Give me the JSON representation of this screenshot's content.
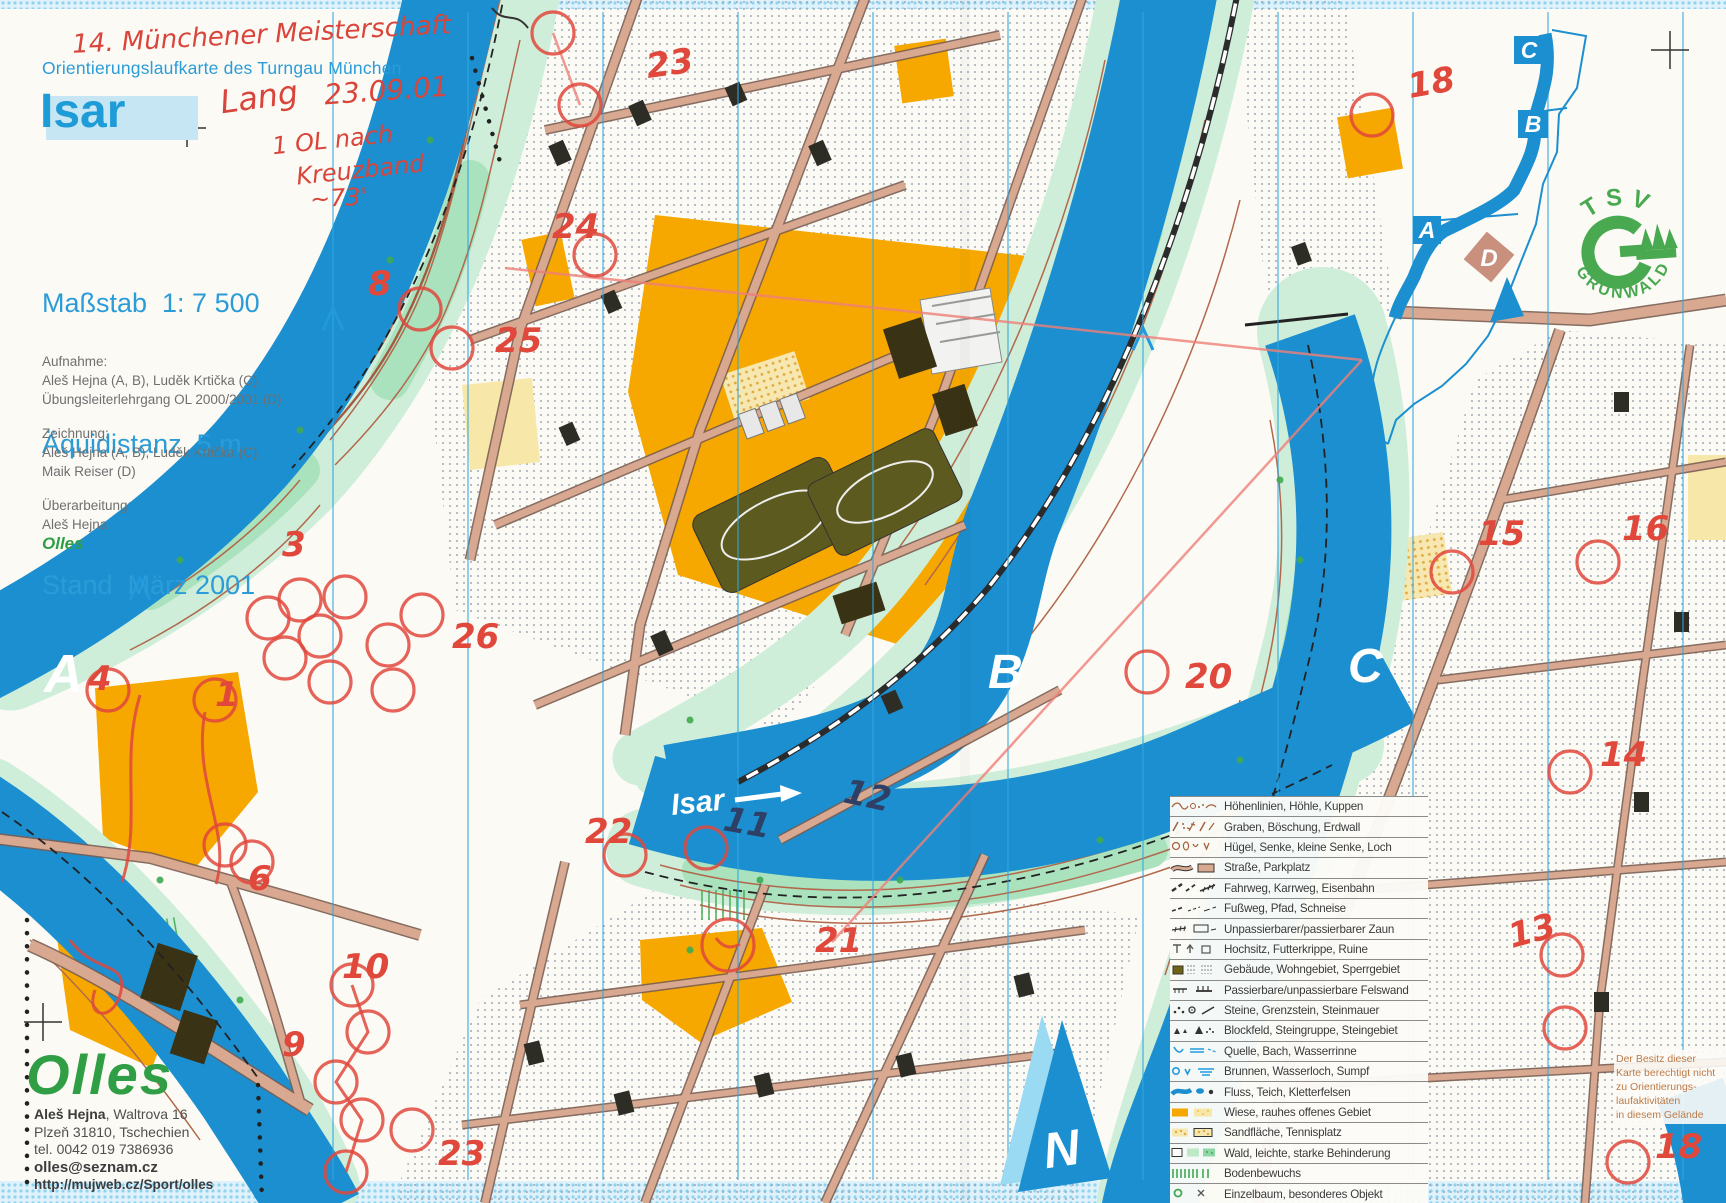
{
  "header": {
    "handwritten_title": "14. Münchener Meisterschaft",
    "subtitle": "Orientierungslaufkarte des Turngau München",
    "title": "Isar",
    "handwritten_course": "Lang",
    "handwritten_date": "23.09.01",
    "handwritten_note1": "1 OL nach",
    "handwritten_note2": "Kreuzband",
    "handwritten_time": "~73'",
    "scale_label": "Maßstab  1: 7 500",
    "equidistance_label": "Äquidistanz  5 m",
    "stand_label": "Stand  März 2001"
  },
  "credits": {
    "survey_heading": "Aufnahme:",
    "survey_line1": "Aleš Hejna (A, B), Luděk Krtička (C),",
    "survey_line2": "Übungsleiterlehrgang OL 2000/2001 (D)",
    "drawing_heading": "Zeichnung:",
    "drawing_line1": "Aleš Hejna (A, B), Luděk Krtička (C),",
    "drawing_line2": "Maik Reiser (D)",
    "revision_heading": "Überarbeitung:",
    "revision_line1": "Aleš Hejna",
    "revision_line2": "Olles"
  },
  "publisher": {
    "logo": "Olles",
    "name": "Aleš Hejna",
    "address_rest": ", Waltrova 16",
    "address_line2": "Plzeň 31810, Tschechien",
    "address_line3": "tel. 0042 019 7386936",
    "email": "olles@seznam.cz",
    "website": "http://mujweb.cz/Sport/olles"
  },
  "map": {
    "river_label": "Isar",
    "sections": {
      "a": "A",
      "b": "B",
      "c": "C"
    },
    "overview": {
      "c": "C",
      "b": "B",
      "a": "A",
      "d": "D"
    },
    "club_logo": {
      "top": "TSV",
      "bottom": "GRÜNWALD"
    },
    "north_label": "N",
    "disclaimer_line1": "Der Besitz dieser",
    "disclaimer_line2": "Karte berechtigt nicht",
    "disclaimer_line3": "zu Orientierungs-",
    "disclaimer_line4": "laufaktivitäten",
    "disclaimer_line5": "in diesem Gelände"
  },
  "legend": {
    "items": [
      {
        "icon": "contours",
        "label": "Höhenlinien, Höhle, Kuppen"
      },
      {
        "icon": "graben",
        "label": "Graben, Böschung, Erdwall"
      },
      {
        "icon": "huegel",
        "label": "Hügel, Senke, kleine Senke, Loch"
      },
      {
        "icon": "strasse",
        "label": "Straße, Parkplatz"
      },
      {
        "icon": "fahrweg",
        "label": "Fahrweg, Karrweg, Eisenbahn"
      },
      {
        "icon": "fussweg",
        "label": "Fußweg, Pfad, Schneise"
      },
      {
        "icon": "zaun",
        "label": "Unpassierbarer/passierbarer Zaun"
      },
      {
        "icon": "hochsitz",
        "label": "Hochsitz, Futterkrippe, Ruine"
      },
      {
        "icon": "gebaeude",
        "label": "Gebäude, Wohngebiet, Sperrgebiet"
      },
      {
        "icon": "felswand",
        "label": "Passierbare/unpassierbare Felswand"
      },
      {
        "icon": "steine",
        "label": "Steine, Grenzstein, Steinmauer"
      },
      {
        "icon": "blockfeld",
        "label": "Blockfeld, Steingruppe, Steingebiet"
      },
      {
        "icon": "quelle",
        "label": "Quelle, Bach, Wasserrinne"
      },
      {
        "icon": "brunnen",
        "label": "Brunnen, Wasserloch, Sumpf"
      },
      {
        "icon": "fluss",
        "label": "Fluss, Teich, Kletterfelsen"
      },
      {
        "icon": "wiese",
        "label": "Wiese, rauhes offenes Gebiet"
      },
      {
        "icon": "sand",
        "label": "Sandfläche, Tennisplatz"
      },
      {
        "icon": "wald",
        "label": "Wald, leichte, starke Behinderung"
      },
      {
        "icon": "bodenbewuchs",
        "label": "Bodenbewuchs"
      },
      {
        "icon": "einzelbaum",
        "label": "Einzelbaum, besonderes Objekt"
      }
    ]
  },
  "course": {
    "circles": [
      [
        553,
        33
      ],
      [
        580,
        105
      ],
      [
        420,
        309
      ],
      [
        595,
        255
      ],
      [
        452,
        348
      ],
      [
        300,
        600
      ],
      [
        345,
        597
      ],
      [
        320,
        636
      ],
      [
        388,
        645
      ],
      [
        285,
        658
      ],
      [
        330,
        682
      ],
      [
        393,
        690
      ],
      [
        268,
        618
      ],
      [
        215,
        700
      ],
      [
        108,
        690
      ],
      [
        422,
        615
      ],
      [
        225,
        845
      ],
      [
        252,
        862
      ],
      [
        352,
        985
      ],
      [
        368,
        1032
      ],
      [
        336,
        1082
      ],
      [
        362,
        1120
      ],
      [
        346,
        1172
      ],
      [
        412,
        1130
      ],
      [
        625,
        855
      ],
      [
        706,
        848
      ],
      [
        728,
        945,
        26
      ],
      [
        1147,
        672
      ],
      [
        1372,
        115
      ],
      [
        1452,
        572
      ],
      [
        1598,
        562
      ],
      [
        1570,
        772
      ],
      [
        1562,
        955
      ],
      [
        1565,
        1028
      ],
      [
        1628,
        1162
      ]
    ],
    "labels": [
      {
        "t": "23",
        "x": 648,
        "y": 78,
        "r": -8
      },
      {
        "t": "24",
        "x": 552,
        "y": 238
      },
      {
        "t": "8",
        "x": 368,
        "y": 295
      },
      {
        "t": "25",
        "x": 495,
        "y": 352
      },
      {
        "t": "3",
        "x": 282,
        "y": 556
      },
      {
        "t": "26",
        "x": 452,
        "y": 648
      },
      {
        "t": "1",
        "x": 215,
        "y": 706
      },
      {
        "t": "4",
        "x": 88,
        "y": 690
      },
      {
        "t": "6",
        "x": 248,
        "y": 890
      },
      {
        "t": "10",
        "x": 342,
        "y": 978
      },
      {
        "t": "9",
        "x": 282,
        "y": 1056
      },
      {
        "t": "23",
        "x": 438,
        "y": 1165
      },
      {
        "t": "22",
        "x": 585,
        "y": 843
      },
      {
        "t": "21",
        "x": 815,
        "y": 952
      },
      {
        "t": "20",
        "x": 1185,
        "y": 688
      },
      {
        "t": "18",
        "x": 1410,
        "y": 98,
        "r": -10
      },
      {
        "t": "15",
        "x": 1478,
        "y": 545
      },
      {
        "t": "16",
        "x": 1622,
        "y": 540
      },
      {
        "t": "14",
        "x": 1600,
        "y": 766
      },
      {
        "t": "13",
        "x": 1512,
        "y": 948,
        "r": -15
      },
      {
        "t": "18",
        "x": 1655,
        "y": 1158
      },
      {
        "t": "11",
        "x": 722,
        "y": 830,
        "r": 10,
        "c": "dark"
      },
      {
        "t": "12",
        "x": 842,
        "y": 802,
        "r": 12,
        "c": "dark"
      }
    ],
    "legs": [
      [
        505,
        268,
        1362,
        360
      ],
      [
        832,
        942,
        1362,
        360
      ],
      [
        553,
        33,
        580,
        105
      ]
    ]
  },
  "colors": {
    "course_red": "#e0483c",
    "pen_dark": "#2e4066",
    "river_blue": "#1b8fd0",
    "title_blue": "#1e9cd8",
    "print_blue": "#2b9cd8",
    "handwriting_red": "#d9453a",
    "olles_green": "#2f9e44",
    "tsv_green": "#3aa344",
    "open_orange": "#f6a800",
    "contour_brown": "#b2684c"
  }
}
